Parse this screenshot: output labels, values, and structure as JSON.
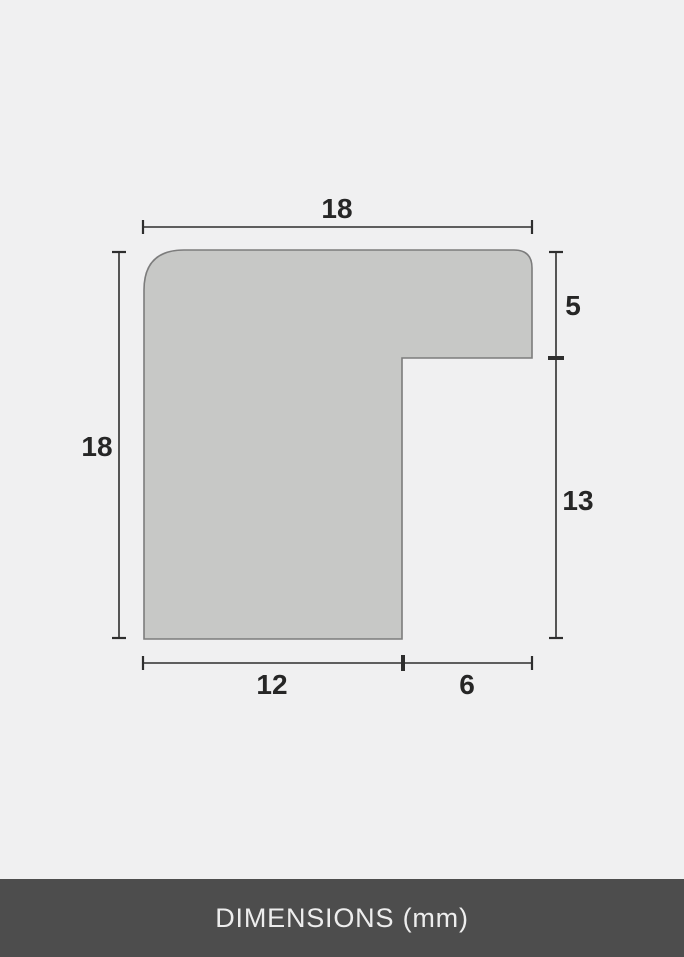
{
  "diagram": {
    "name": "picture-frame-profile-cross-section",
    "unit": "mm",
    "labels": {
      "top_width": "18",
      "left_height": "18",
      "right_upper_depth": "5",
      "right_lower_height": "13",
      "bottom_inner_width": "12",
      "bottom_rebate_width": "6"
    }
  },
  "footer": {
    "label": "DIMENSIONS (mm)"
  },
  "colors": {
    "background": "#f0f0f1",
    "shape_fill": "#c7c8c6",
    "shape_border": "#7c7c7c",
    "dimension_line": "#2e2e2e",
    "label_text": "#262626",
    "footer_bg": "#4d4d4d",
    "footer_text": "#ededed"
  }
}
